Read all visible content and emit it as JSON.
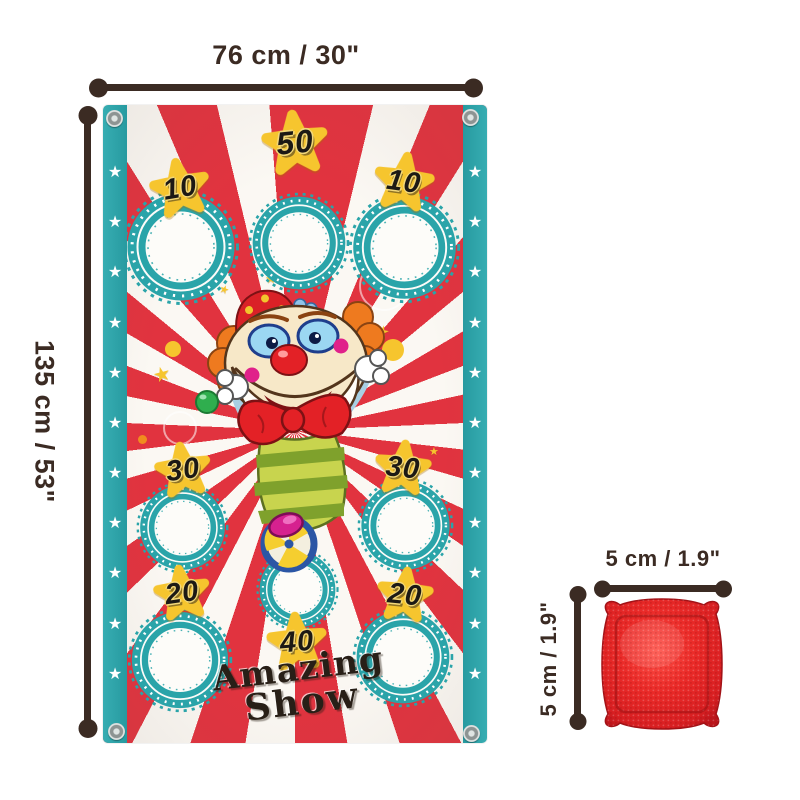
{
  "dims": {
    "banner_width": "76 cm / 30\"",
    "banner_height": "135 cm / 53\"",
    "bag_width": "5 cm / 1.9\"",
    "bag_height": "5 cm / 1.9\""
  },
  "banner": {
    "brand": {
      "line1": "Amazing",
      "line2": "Show"
    },
    "holes": [
      {
        "position": "top-left",
        "score": "10"
      },
      {
        "position": "top-center",
        "score": "50"
      },
      {
        "position": "top-right",
        "score": "10"
      },
      {
        "position": "middle-left",
        "score": "30"
      },
      {
        "position": "middle-right",
        "score": "30"
      },
      {
        "position": "bottom-left",
        "score": "20"
      },
      {
        "position": "bottom-center",
        "score": "40"
      },
      {
        "position": "bottom-right",
        "score": "20"
      }
    ]
  },
  "colors": {
    "teal": "#2aa4a9",
    "ray_red": "#e1333f",
    "star_yellow": "#f6c52e",
    "dimension_brown": "#3b2b23",
    "bag_red": "#e52a28"
  }
}
